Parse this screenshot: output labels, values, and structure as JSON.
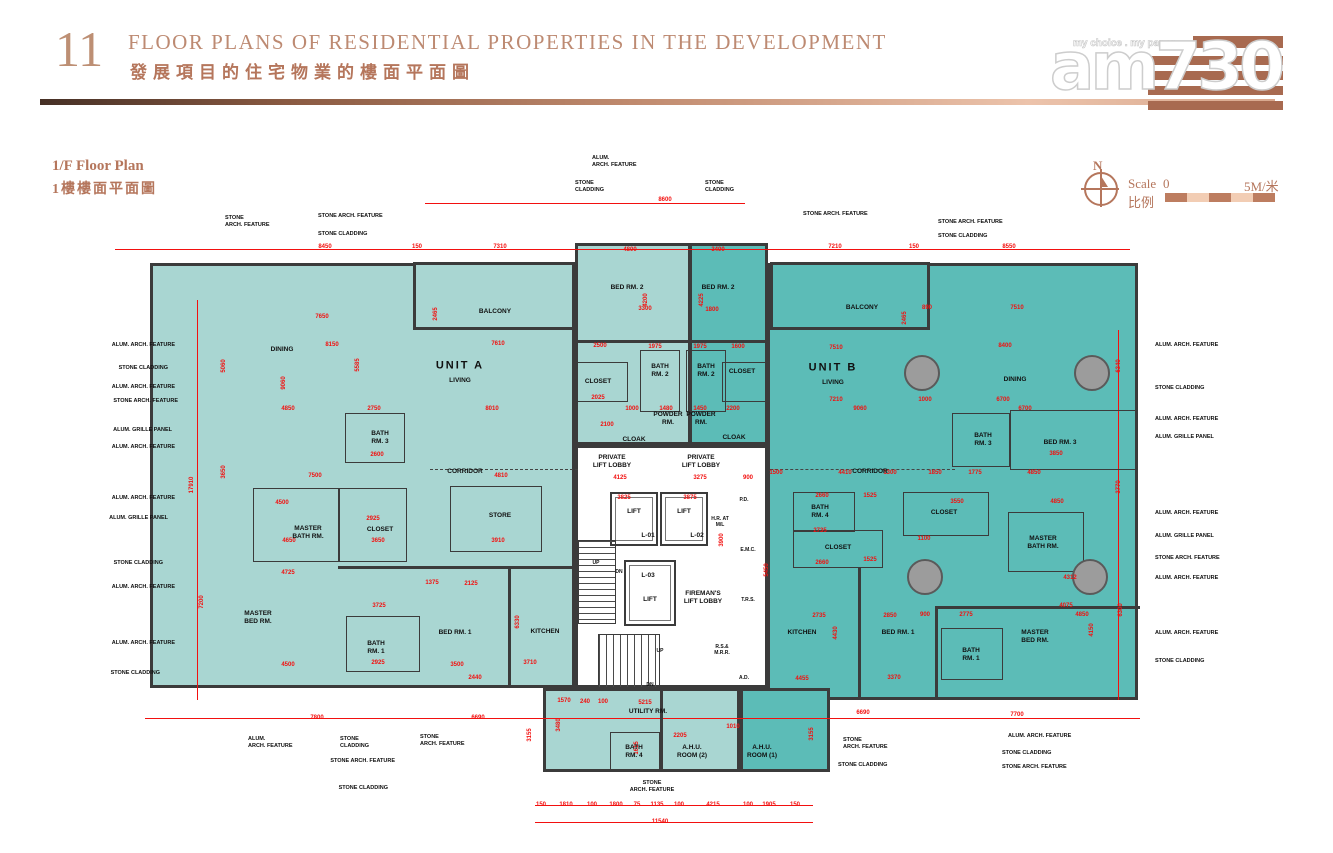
{
  "page": {
    "number": "11",
    "title_en": "FLOOR PLANS OF RESIDENTIAL PROPERTIES IN THE DEVELOPMENT",
    "title_zh": "發展項目的住宅物業的樓面平面圖"
  },
  "logo": {
    "name": "am730",
    "tagline": "my choice . my paper"
  },
  "floor_label": {
    "en": "1/F Floor Plan",
    "zh": "1樓樓面平面圖"
  },
  "compass": {
    "north": "N"
  },
  "scale": {
    "label_en": "Scale",
    "label_zh": "比例",
    "start": "0",
    "end": "5M/米"
  },
  "colors": {
    "copper": "#b5765c",
    "unit_a_fill": "#a9d6d2",
    "unit_b_fill": "#5cbcb7",
    "dimension_red": "#f2100f",
    "wall": "#3b3b3b"
  },
  "plan": {
    "blocks": [
      {
        "x": 150,
        "y": 263,
        "w": 425,
        "h": 425,
        "f": "a"
      },
      {
        "x": 575,
        "y": 243,
        "w": 116,
        "h": 202,
        "f": "a"
      },
      {
        "x": 689,
        "y": 243,
        "w": 79,
        "h": 202,
        "f": "b"
      },
      {
        "x": 767,
        "y": 263,
        "w": 371,
        "h": 437,
        "f": "b"
      },
      {
        "x": 543,
        "y": 688,
        "w": 197,
        "h": 84,
        "f": "a"
      },
      {
        "x": 740,
        "y": 688,
        "w": 90,
        "h": 84,
        "f": "b"
      },
      {
        "x": 413,
        "y": 262,
        "w": 162,
        "h": 68,
        "f": "a"
      },
      {
        "x": 770,
        "y": 262,
        "w": 160,
        "h": 68,
        "f": "b"
      },
      {
        "x": 575,
        "y": 445,
        "w": 193,
        "h": 243,
        "f": "w"
      }
    ],
    "boxes": [
      [
        345,
        413,
        60,
        50
      ],
      [
        640,
        350,
        40,
        62
      ],
      [
        686,
        350,
        40,
        62
      ],
      [
        572,
        362,
        56,
        40
      ],
      [
        722,
        362,
        44,
        40
      ],
      [
        253,
        488,
        86,
        74
      ],
      [
        339,
        488,
        68,
        74
      ],
      [
        450,
        486,
        92,
        66
      ],
      [
        346,
        616,
        74,
        56
      ],
      [
        952,
        413,
        58,
        54
      ],
      [
        1010,
        410,
        128,
        60
      ],
      [
        793,
        492,
        62,
        40
      ],
      [
        793,
        530,
        90,
        38
      ],
      [
        903,
        492,
        86,
        44
      ],
      [
        1008,
        512,
        76,
        60
      ],
      [
        941,
        628,
        62,
        52
      ],
      [
        610,
        732,
        50,
        38
      ]
    ],
    "walls": [
      [
        508,
        568,
        3,
        120
      ],
      [
        338,
        566,
        240,
        3
      ],
      [
        858,
        568,
        3,
        132
      ],
      [
        935,
        606,
        205,
        3
      ],
      [
        935,
        606,
        3,
        94
      ],
      [
        575,
        340,
        193,
        3
      ],
      [
        660,
        688,
        3,
        84
      ]
    ],
    "dashed": [
      [
        430,
        469,
        148,
        2
      ],
      [
        770,
        469,
        185,
        2
      ]
    ],
    "lifts": [
      [
        610,
        492,
        48,
        54
      ],
      [
        660,
        492,
        48,
        54
      ],
      [
        624,
        560,
        52,
        66
      ]
    ],
    "stairs": [
      [
        578,
        540,
        38,
        84,
        "v"
      ],
      [
        598,
        634,
        62,
        54,
        "h"
      ]
    ],
    "columns": [
      [
        922,
        373,
        18
      ],
      [
        1092,
        373,
        18
      ],
      [
        925,
        577,
        18
      ],
      [
        1090,
        577,
        18
      ]
    ],
    "redlines": [
      [
        115,
        249,
        1015,
        1
      ],
      [
        425,
        203,
        320,
        1
      ],
      [
        145,
        718,
        995,
        1
      ],
      [
        535,
        805,
        278,
        1
      ],
      [
        535,
        822,
        278,
        1
      ],
      [
        197,
        300,
        1,
        400
      ],
      [
        1118,
        330,
        1,
        370
      ]
    ],
    "rooms": [
      [
        "DINING",
        282,
        350
      ],
      [
        "UNIT A",
        460,
        366,
        11
      ],
      [
        "LIVING",
        460,
        381
      ],
      [
        "BALCONY",
        495,
        312
      ],
      [
        "BED RM. 2",
        627,
        288
      ],
      [
        "BED RM. 2",
        718,
        288
      ],
      [
        "CLOSET",
        598,
        382
      ],
      [
        "BATH\nRM. 2",
        660,
        371
      ],
      [
        "BATH\nRM. 2",
        706,
        371
      ],
      [
        "CLOSET",
        742,
        372
      ],
      [
        "BATH\nRM. 3",
        380,
        438
      ],
      [
        "POWDER\nRM.",
        668,
        419
      ],
      [
        "POWDER\nRM.",
        701,
        419
      ],
      [
        "CLOAK",
        634,
        440
      ],
      [
        "CLOAK",
        734,
        438
      ],
      [
        "PRIVATE\nLIFT LOBBY",
        612,
        462
      ],
      [
        "PRIVATE\nLIFT LOBBY",
        701,
        462
      ],
      [
        "CORRIDOR",
        465,
        472
      ],
      [
        "STORE",
        500,
        516
      ],
      [
        "MASTER\nBATH RM.",
        308,
        533
      ],
      [
        "CLOSET",
        380,
        530
      ],
      [
        "MASTER\nBED RM.",
        258,
        618
      ],
      [
        "BATH\nRM. 1",
        376,
        648
      ],
      [
        "BED RM. 1",
        455,
        633
      ],
      [
        "KITCHEN",
        545,
        632
      ],
      [
        "UTILITY RM.",
        648,
        712
      ],
      [
        "BATH\nRM. 4",
        634,
        752
      ],
      [
        "A.H.U.\nROOM (2)",
        692,
        752
      ],
      [
        "A.H.U.\nROOM (1)",
        762,
        752
      ],
      [
        "BALCONY",
        862,
        308
      ],
      [
        "UNIT B",
        833,
        368,
        11
      ],
      [
        "LIVING",
        833,
        383
      ],
      [
        "DINING",
        1015,
        380
      ],
      [
        "BATH\nRM. 3",
        983,
        440
      ],
      [
        "BED RM. 3",
        1060,
        443
      ],
      [
        "CORRIDOR",
        870,
        472
      ],
      [
        "BATH\nRM. 4",
        820,
        512
      ],
      [
        "CLOSET",
        838,
        548
      ],
      [
        "CLOSET",
        944,
        513
      ],
      [
        "MASTER\nBATH RM.",
        1043,
        543
      ],
      [
        "KITCHEN",
        802,
        633
      ],
      [
        "BED RM. 1",
        898,
        633
      ],
      [
        "BATH\nRM. 1",
        971,
        655
      ],
      [
        "MASTER\nBED RM.",
        1035,
        637
      ],
      [
        "LIFT",
        634,
        512
      ],
      [
        "L-01",
        648,
        536
      ],
      [
        "LIFT",
        684,
        512
      ],
      [
        "L-02",
        697,
        536
      ],
      [
        "L-03",
        648,
        576
      ],
      [
        "LIFT",
        650,
        600
      ],
      [
        "FIREMAN'S\nLIFT LOBBY",
        703,
        598
      ],
      [
        "H.R. AT\nM/L",
        720,
        522,
        5
      ],
      [
        "P.D.",
        744,
        500,
        5
      ],
      [
        "E.M.C.",
        748,
        550,
        5
      ],
      [
        "T.R.S.",
        748,
        600,
        5
      ],
      [
        "R.S.&\nM.R.R.",
        722,
        650,
        5
      ],
      [
        "A.D.",
        744,
        678,
        5
      ],
      [
        "UP",
        596,
        563,
        5
      ],
      [
        "DN",
        619,
        572,
        5
      ],
      [
        "UP",
        660,
        651,
        5
      ],
      [
        "DN",
        650,
        685,
        5
      ]
    ],
    "dims": [
      [
        "8600",
        665,
        200
      ],
      [
        "8450",
        325,
        247
      ],
      [
        "150",
        417,
        247
      ],
      [
        "7310",
        500,
        247
      ],
      [
        "7210",
        835,
        247
      ],
      [
        "150",
        914,
        247
      ],
      [
        "8550",
        1009,
        247
      ],
      [
        "17910",
        192,
        485,
        1
      ],
      [
        "5060",
        224,
        366,
        1
      ],
      [
        "3650",
        224,
        472,
        1
      ],
      [
        "7200",
        202,
        602,
        1
      ],
      [
        "6340",
        1119,
        366,
        1
      ],
      [
        "3770",
        1119,
        487,
        1
      ],
      [
        "6300",
        1121,
        610,
        1
      ],
      [
        "7800",
        317,
        718
      ],
      [
        "6690",
        478,
        718
      ],
      [
        "6690",
        863,
        713
      ],
      [
        "7700",
        1017,
        715
      ],
      [
        "3155",
        530,
        735,
        1
      ],
      [
        "3155",
        812,
        734,
        1
      ],
      [
        "150",
        541,
        805
      ],
      [
        "1810",
        566,
        805
      ],
      [
        "100",
        592,
        805
      ],
      [
        "1800",
        616,
        805
      ],
      [
        "75",
        637,
        805
      ],
      [
        "1135",
        657,
        805
      ],
      [
        "100",
        679,
        805
      ],
      [
        "4215",
        713,
        805
      ],
      [
        "100",
        748,
        805
      ],
      [
        "1905",
        769,
        805
      ],
      [
        "150",
        795,
        805
      ],
      [
        "11540",
        660,
        822
      ],
      [
        "7650",
        322,
        317
      ],
      [
        "8150",
        332,
        345
      ],
      [
        "5585",
        358,
        365,
        1
      ],
      [
        "9060",
        284,
        383,
        1
      ],
      [
        "4850",
        288,
        409
      ],
      [
        "2750",
        374,
        409
      ],
      [
        "8010",
        492,
        409
      ],
      [
        "7610",
        498,
        344
      ],
      [
        "2465",
        436,
        314,
        1
      ],
      [
        "2500",
        600,
        346
      ],
      [
        "2100",
        607,
        425
      ],
      [
        "7500",
        315,
        476
      ],
      [
        "2600",
        377,
        455
      ],
      [
        "4810",
        501,
        476
      ],
      [
        "2925",
        373,
        519
      ],
      [
        "3650",
        378,
        541
      ],
      [
        "4650",
        289,
        541
      ],
      [
        "3910",
        498,
        541
      ],
      [
        "4500",
        282,
        503
      ],
      [
        "4725",
        288,
        573
      ],
      [
        "3725",
        379,
        606
      ],
      [
        "1375",
        432,
        583
      ],
      [
        "2125",
        471,
        584
      ],
      [
        "2925",
        378,
        663
      ],
      [
        "4500",
        288,
        665
      ],
      [
        "3500",
        457,
        665
      ],
      [
        "3710",
        530,
        663
      ],
      [
        "2440",
        475,
        678
      ],
      [
        "6330",
        518,
        622,
        1
      ],
      [
        "4800",
        630,
        250
      ],
      [
        "3400",
        718,
        250
      ],
      [
        "4200",
        646,
        300,
        1
      ],
      [
        "4225",
        702,
        300,
        1
      ],
      [
        "3300",
        645,
        309
      ],
      [
        "1800",
        712,
        310
      ],
      [
        "1975",
        655,
        347
      ],
      [
        "1975",
        700,
        347
      ],
      [
        "1600",
        738,
        347
      ],
      [
        "2025",
        598,
        398
      ],
      [
        "1000",
        632,
        409
      ],
      [
        "1480",
        666,
        409
      ],
      [
        "1450",
        700,
        409
      ],
      [
        "2200",
        733,
        409
      ],
      [
        "4125",
        620,
        478
      ],
      [
        "3275",
        700,
        478
      ],
      [
        "900",
        748,
        478
      ],
      [
        "1500",
        776,
        473
      ],
      [
        "3825",
        624,
        498
      ],
      [
        "3875",
        690,
        498
      ],
      [
        "3900",
        722,
        540,
        1
      ],
      [
        "5450",
        767,
        570,
        1
      ],
      [
        "5215",
        645,
        703
      ],
      [
        "1570",
        564,
        701
      ],
      [
        "240",
        585,
        702
      ],
      [
        "100",
        603,
        702
      ],
      [
        "2205",
        680,
        736
      ],
      [
        "1010",
        733,
        727
      ],
      [
        "3480",
        559,
        725,
        1
      ],
      [
        "1615",
        637,
        748,
        1
      ],
      [
        "4455",
        802,
        679
      ],
      [
        "7510",
        1017,
        308
      ],
      [
        "890",
        927,
        308
      ],
      [
        "8400",
        1005,
        346
      ],
      [
        "7510",
        836,
        348
      ],
      [
        "2465",
        905,
        318,
        1
      ],
      [
        "9060",
        860,
        409
      ],
      [
        "7210",
        836,
        400
      ],
      [
        "1000",
        925,
        400
      ],
      [
        "6700",
        1003,
        400
      ],
      [
        "6700",
        1025,
        409
      ],
      [
        "4410",
        845,
        473
      ],
      [
        "1300",
        890,
        473
      ],
      [
        "1850",
        935,
        473
      ],
      [
        "1775",
        975,
        473
      ],
      [
        "4850",
        1034,
        473
      ],
      [
        "3850",
        1056,
        454
      ],
      [
        "2660",
        822,
        496
      ],
      [
        "1525",
        870,
        496
      ],
      [
        "3550",
        957,
        502
      ],
      [
        "4850",
        1057,
        502
      ],
      [
        "2735",
        820,
        531
      ],
      [
        "1100",
        924,
        539
      ],
      [
        "2660",
        822,
        563
      ],
      [
        "1525",
        870,
        560
      ],
      [
        "4312",
        1070,
        578
      ],
      [
        "4075",
        1066,
        606
      ],
      [
        "4850",
        1082,
        615
      ],
      [
        "2735",
        819,
        616
      ],
      [
        "2850",
        890,
        616
      ],
      [
        "900",
        925,
        615
      ],
      [
        "2775",
        966,
        615
      ],
      [
        "4150",
        1092,
        630,
        1
      ],
      [
        "4430",
        836,
        633,
        1
      ],
      [
        "3370",
        894,
        678
      ]
    ],
    "callouts": [
      [
        "STONE\nARCH. FEATURE",
        225,
        215,
        "l"
      ],
      [
        "STONE ARCH. FEATURE",
        318,
        213,
        "l"
      ],
      [
        "STONE CLADDING",
        318,
        231,
        "l"
      ],
      [
        "ALUM.\nARCH. FEATURE",
        592,
        155,
        "l"
      ],
      [
        "STONE\nCLADDING",
        575,
        180,
        "l"
      ],
      [
        "STONE\nCLADDING",
        705,
        180,
        "l"
      ],
      [
        "STONE ARCH. FEATURE",
        803,
        211,
        "l"
      ],
      [
        "STONE ARCH. FEATURE",
        938,
        219,
        "l"
      ],
      [
        "STONE CLADDING",
        938,
        233,
        "l"
      ],
      [
        "ALUM. ARCH. FEATURE",
        175,
        342,
        "r"
      ],
      [
        "STONE CLADDING",
        168,
        365,
        "r"
      ],
      [
        "ALUM. ARCH. FEATURE",
        175,
        384,
        "r"
      ],
      [
        "STONE ARCH. FEATURE",
        178,
        398,
        "r"
      ],
      [
        "ALUM. GRILLE PANEL",
        172,
        427,
        "r"
      ],
      [
        "ALUM. ARCH. FEATURE",
        175,
        444,
        "r"
      ],
      [
        "ALUM. ARCH. FEATURE",
        175,
        495,
        "r"
      ],
      [
        "ALUM. GRILLE PANEL",
        168,
        515,
        "r"
      ],
      [
        "STONE CLADDING",
        163,
        560,
        "r"
      ],
      [
        "ALUM. ARCH. FEATURE",
        175,
        584,
        "r"
      ],
      [
        "ALUM. ARCH. FEATURE",
        175,
        640,
        "r"
      ],
      [
        "STONE CLADDING",
        160,
        670,
        "r"
      ],
      [
        "ALUM. ARCH. FEATURE",
        1155,
        342,
        "l"
      ],
      [
        "STONE CLADDING",
        1155,
        385,
        "l"
      ],
      [
        "ALUM. ARCH. FEATURE",
        1155,
        416,
        "l"
      ],
      [
        "ALUM. GRILLE PANEL",
        1155,
        434,
        "l"
      ],
      [
        "ALUM. ARCH. FEATURE",
        1155,
        510,
        "l"
      ],
      [
        "ALUM. GRILLE PANEL",
        1155,
        533,
        "l"
      ],
      [
        "STONE ARCH. FEATURE",
        1155,
        555,
        "l"
      ],
      [
        "ALUM. ARCH. FEATURE",
        1155,
        575,
        "l"
      ],
      [
        "ALUM. ARCH. FEATURE",
        1155,
        630,
        "l"
      ],
      [
        "STONE CLADDING",
        1155,
        658,
        "l"
      ],
      [
        "ALUM.\nARCH. FEATURE",
        248,
        736,
        "l"
      ],
      [
        "STONE\nCLADDING",
        340,
        736,
        "l"
      ],
      [
        "STONE\nARCH. FEATURE",
        420,
        734,
        "l"
      ],
      [
        "STONE ARCH. FEATURE",
        395,
        758,
        "r"
      ],
      [
        "STONE CLADDING",
        388,
        785,
        "r"
      ],
      [
        "STONE\nARCH. FEATURE",
        652,
        780,
        "c"
      ],
      [
        "STONE\nARCH. FEATURE",
        843,
        737,
        "l"
      ],
      [
        "STONE CLADDING",
        838,
        762,
        "l"
      ],
      [
        "ALUM. ARCH. FEATURE",
        1008,
        733,
        "l"
      ],
      [
        "STONE CLADDING",
        1002,
        750,
        "l"
      ],
      [
        "STONE ARCH. FEATURE",
        1002,
        764,
        "l"
      ]
    ]
  }
}
